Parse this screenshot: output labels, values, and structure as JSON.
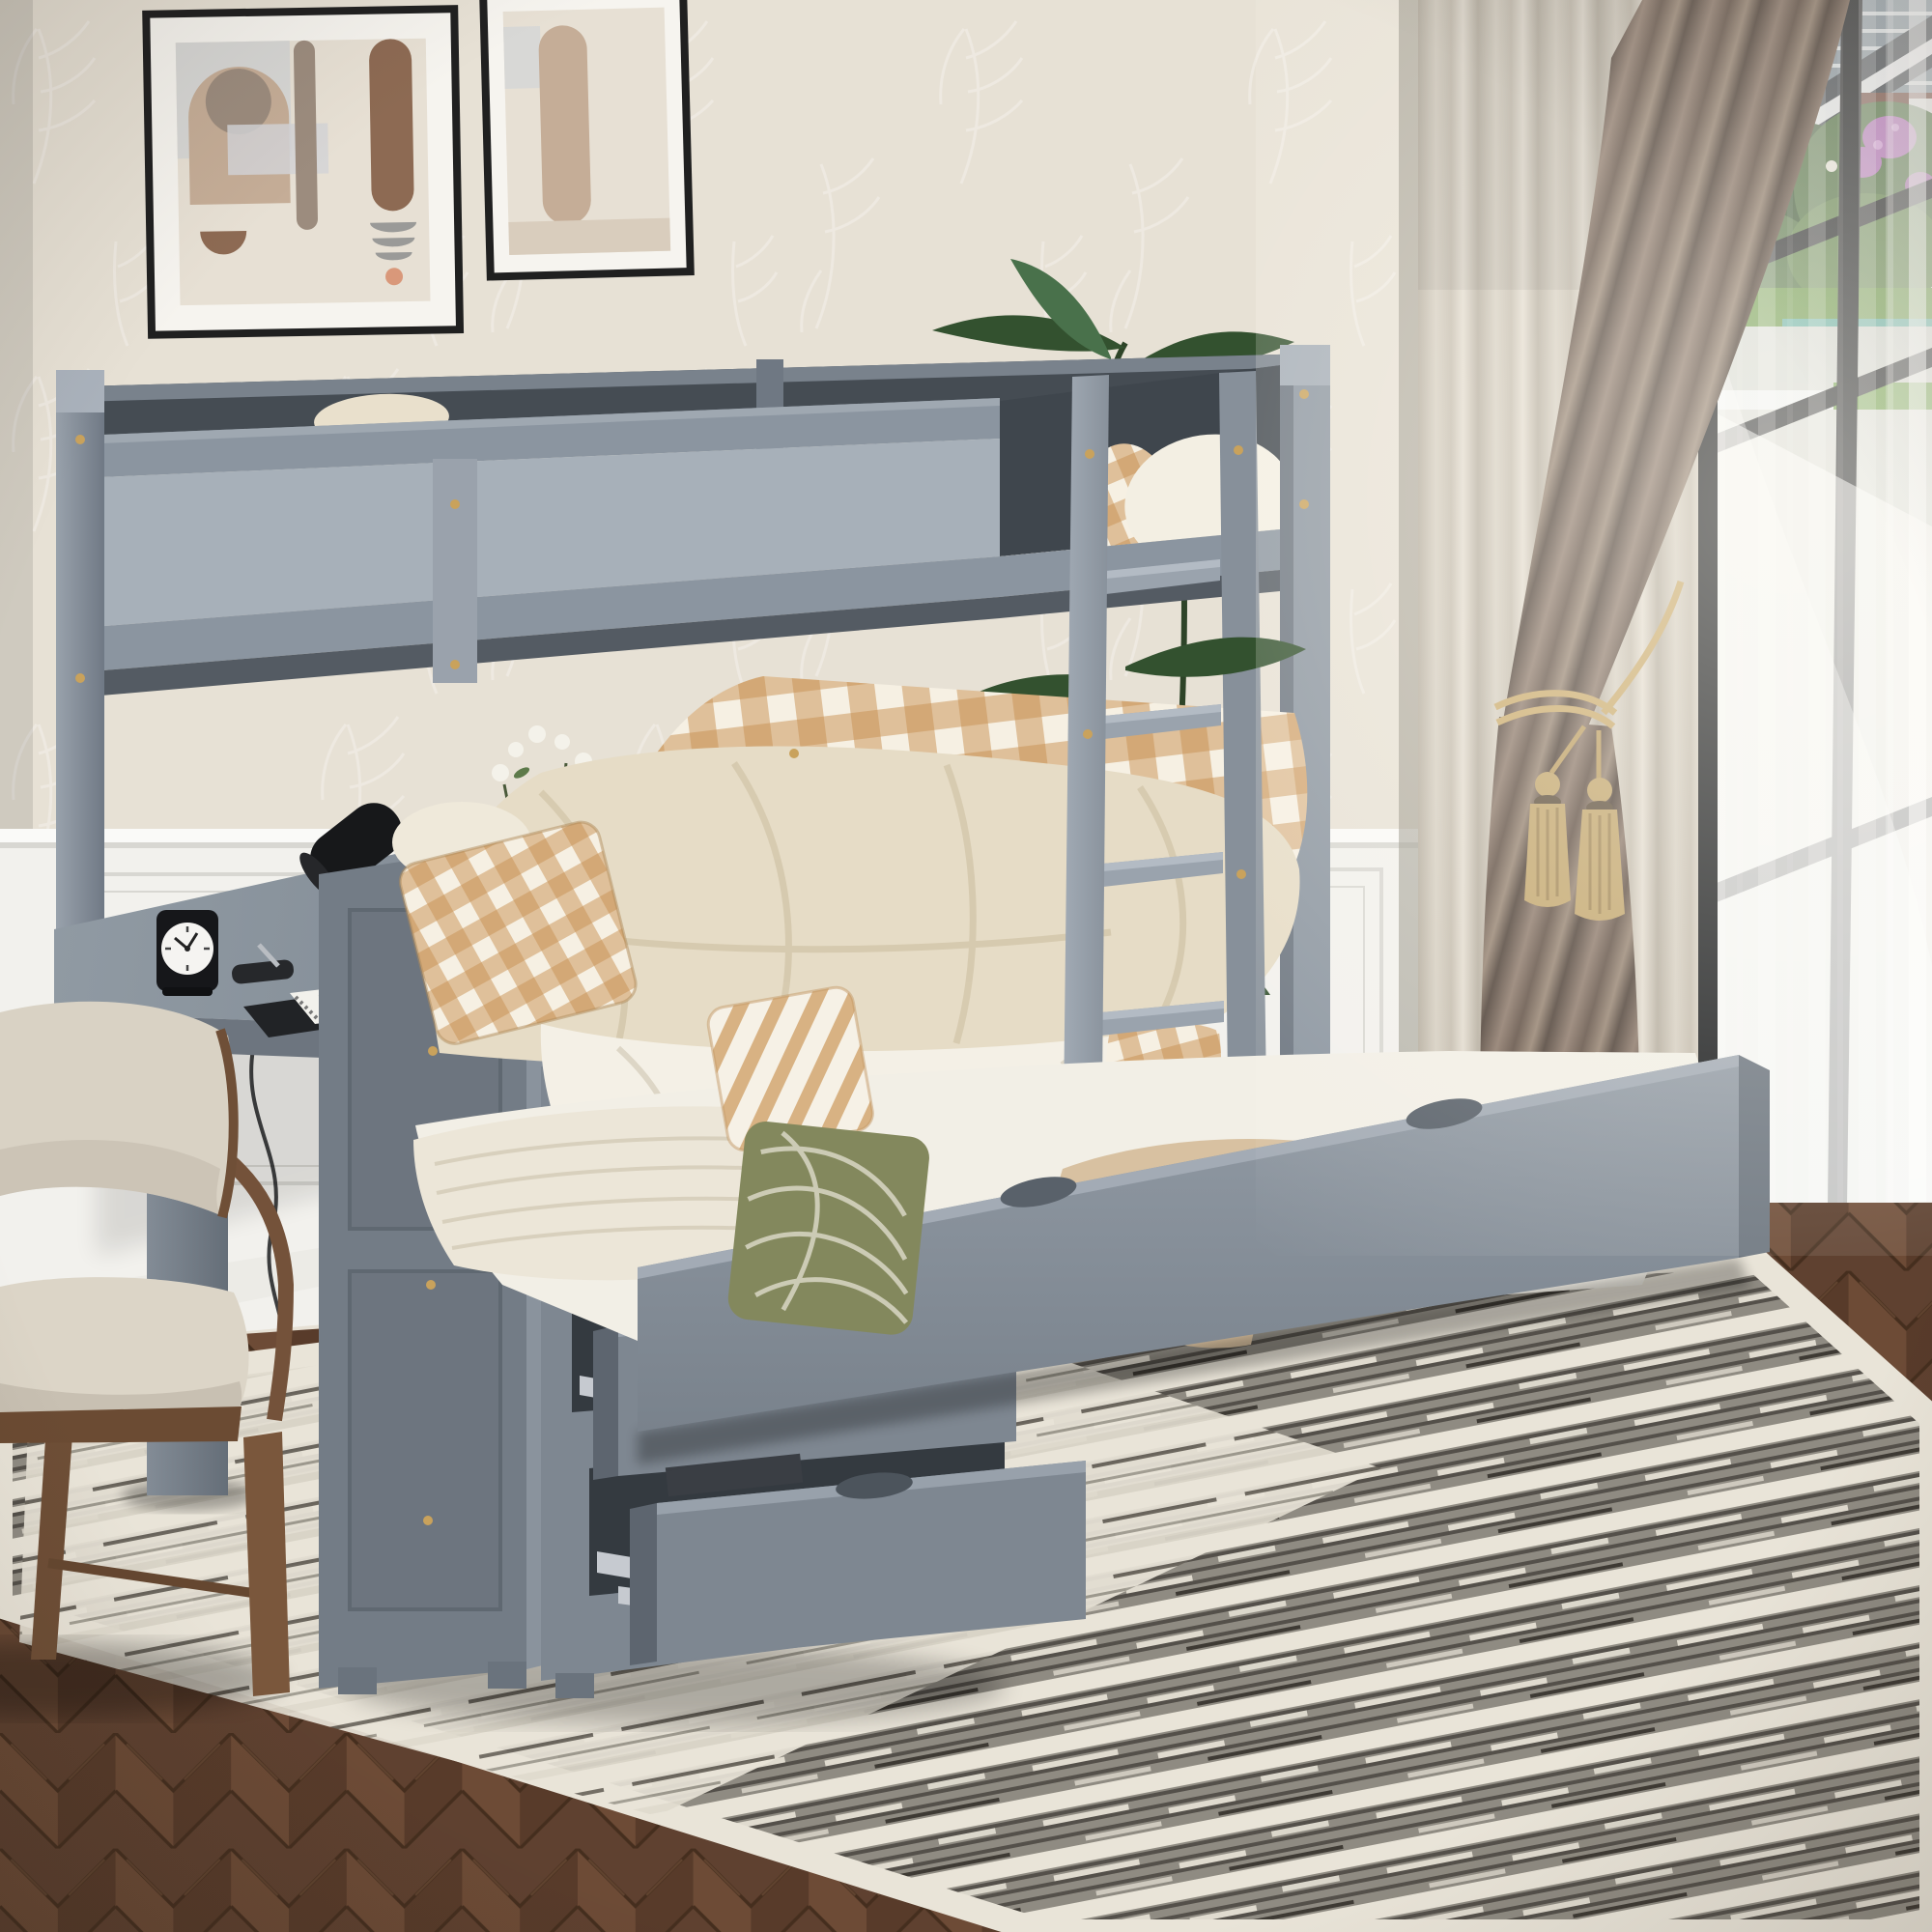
{
  "scene": {
    "title": "Gray twin-over-full bunk bed with built-in desk, three open storage drawers and pull-out trundle in a bedroom",
    "clock_time": "10:09",
    "open_drawers": 3,
    "ladder_rungs": 5,
    "wall_art_frames": 2,
    "curtain_tassels": 2,
    "pillows": [
      "plaid",
      "stripe",
      "green-swirl"
    ]
  },
  "palette": {
    "wall": "#e7e1d5",
    "wall-motif": "#f7f4ec",
    "wainscot": "#f2f1ed",
    "wainscot-line": "#d8d7d2",
    "bed-gray": "#8b95a0",
    "bed-gray-light": "#a7b0b9",
    "bed-gray-dark": "#6a727b",
    "bed-interior": "#454c53",
    "soffit": "#545b63",
    "desk-edge": "#6d757f",
    "cabinet-side": "#737c86",
    "drawer-front": "#7e8791",
    "cavity": "#343a40",
    "slide-metal": "#c6cad0",
    "mattress-white": "#f2efe6",
    "duvet-cream": "#e6dcc6",
    "sheet-white": "#f4f0e6",
    "plaid-tan": "#c88f52",
    "pillow-green": "#8f9465",
    "clothes-beige": "#d8c1a1",
    "knit-cream": "#ece6d8",
    "chair-wood": "#73523a",
    "chair-fabric": "#d9d2c4",
    "rug-cream": "#e9e4d8",
    "rug-gray": "#8f8b82",
    "rug-dark": "#54504a",
    "curtain-beige": "#c9c2b6",
    "curtain-brown": "#8a7668",
    "curtain-brown-dark": "#4a3c33",
    "tassel-gold": "#c0a369",
    "window-frame": "#181a1c",
    "sky": "#eef1f3",
    "siding": "#8795a0",
    "roof": "#3c4249",
    "brick": "#71463a",
    "bush": "#4e7040",
    "bush-dark": "#32502c",
    "grass": "#679543",
    "flower-purple": "#b671bd",
    "path-gray": "#d3d6d0",
    "pool-teal": "#5fb3b0",
    "plant-green": "#33512f",
    "plant-green-light": "#49714b",
    "lamp-black": "#17181a",
    "metal-silver": "#b9bdc2",
    "clock-face": "#f5f4f1",
    "art-frame": "#202020",
    "art-mat": "#f6f4ef",
    "art-bg": "#e7e0d4",
    "art-tan": "#c5ad97",
    "art-taupe": "#9c8c7e",
    "art-brown": "#8d6a53",
    "art-salmon": "#d9987a",
    "screw-gold": "#c9a25c"
  }
}
